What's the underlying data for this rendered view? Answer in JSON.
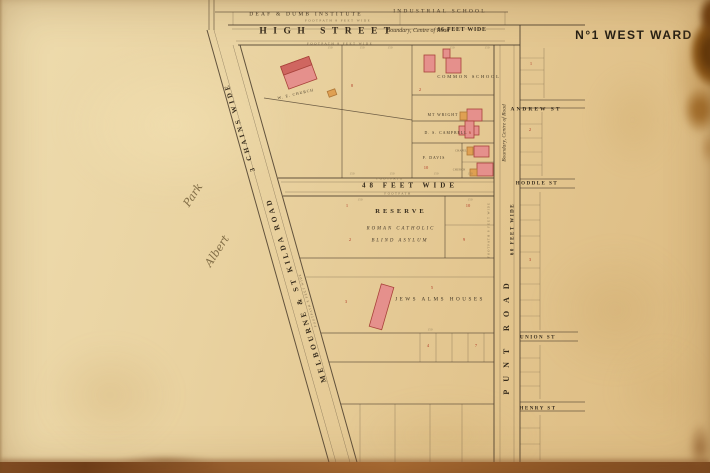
{
  "title": "N°1 WEST WARD",
  "colors": {
    "paper": "#e8d2a2",
    "ink": "#4b3d2c",
    "building_pink": "#e5908c",
    "building_outline": "#a8423a",
    "building_orange": "#dfa052",
    "lot_number_red": "#b23d2a",
    "stain_brown": "#6b3a0c"
  },
  "labels": {
    "deaf_dumb": "DEAF & DUMB INSTITUTE",
    "industrial_school": "INDUSTRIAL SCHOOL",
    "high_street": "HIGH STREET",
    "high_boundary": "Boundary, Centre of Road",
    "high_width": "66 FEET WIDE",
    "footpath_high_n": "FOOTPATH 8 FEET WIDE",
    "footpath_high_s": "FOOTPATH 8 FEET WIDE",
    "st_kilda_road": "MELBOURNE & ST KILDA ROAD",
    "st_kilda_width": "3 CHAINS WIDE",
    "st_kilda_footpath": "FOOTPATH 8 FEET WIDE",
    "punt_road": "PUNT ROAD",
    "punt_width": "60 FEET WIDE",
    "punt_boundary": "Boundary, Centre of Road",
    "punt_footpath": "FOOTPATH 8 FEET WIDE",
    "cross_width": "48 FEET WIDE",
    "cross_footpath_n": "FOOTPATH",
    "cross_footpath_s": "FOOTPATH",
    "andrew": "ANDREW ST",
    "hoddle": "HODDLE ST",
    "union": "UNION ST",
    "henry": "HENRY ST",
    "common_school": "COMMON SCHOOL",
    "church": "W. E. CHURCH",
    "wright": "MT WRIGHT",
    "campbell": "D. S. CAMPBELL",
    "davis": "P. DAVIS",
    "chapel_a": "CHAPEL",
    "chapel_b": "CHURCH",
    "reserve": "RESERVE",
    "reserve_line2": "ROMAN CATHOLIC",
    "reserve_line3": "BLIND ASYLUM",
    "jews": "JEWS ALMS HOUSES",
    "park_upper": "Park",
    "park_lower": "Albert"
  },
  "lot_numbers": [
    {
      "x": 352,
      "y": 86,
      "v": "8"
    },
    {
      "x": 420,
      "y": 90,
      "v": "2"
    },
    {
      "x": 470,
      "y": 133,
      "v": "6"
    },
    {
      "x": 426,
      "y": 168,
      "v": "10"
    },
    {
      "x": 347,
      "y": 206,
      "v": "1"
    },
    {
      "x": 468,
      "y": 206,
      "v": "10"
    },
    {
      "x": 350,
      "y": 240,
      "v": "2"
    },
    {
      "x": 464,
      "y": 240,
      "v": "9"
    },
    {
      "x": 432,
      "y": 288,
      "v": "5"
    },
    {
      "x": 346,
      "y": 302,
      "v": "3"
    },
    {
      "x": 428,
      "y": 346,
      "v": "4"
    },
    {
      "x": 476,
      "y": 346,
      "v": "7"
    },
    {
      "x": 531,
      "y": 64,
      "v": "1"
    },
    {
      "x": 530,
      "y": 130,
      "v": "2"
    },
    {
      "x": 530,
      "y": 260,
      "v": "3"
    }
  ],
  "dimension_marks": [
    {
      "x": 330,
      "y": 48,
      "v": "150"
    },
    {
      "x": 362,
      "y": 48,
      "v": "150"
    },
    {
      "x": 390,
      "y": 48,
      "v": "150"
    },
    {
      "x": 452,
      "y": 48,
      "v": "150"
    },
    {
      "x": 487,
      "y": 48,
      "v": "150"
    },
    {
      "x": 352,
      "y": 174,
      "v": "150"
    },
    {
      "x": 392,
      "y": 174,
      "v": "150"
    },
    {
      "x": 436,
      "y": 174,
      "v": "150"
    },
    {
      "x": 470,
      "y": 174,
      "v": "150"
    },
    {
      "x": 360,
      "y": 200,
      "v": "150"
    },
    {
      "x": 470,
      "y": 200,
      "v": "150"
    },
    {
      "x": 430,
      "y": 330,
      "v": "150"
    }
  ]
}
